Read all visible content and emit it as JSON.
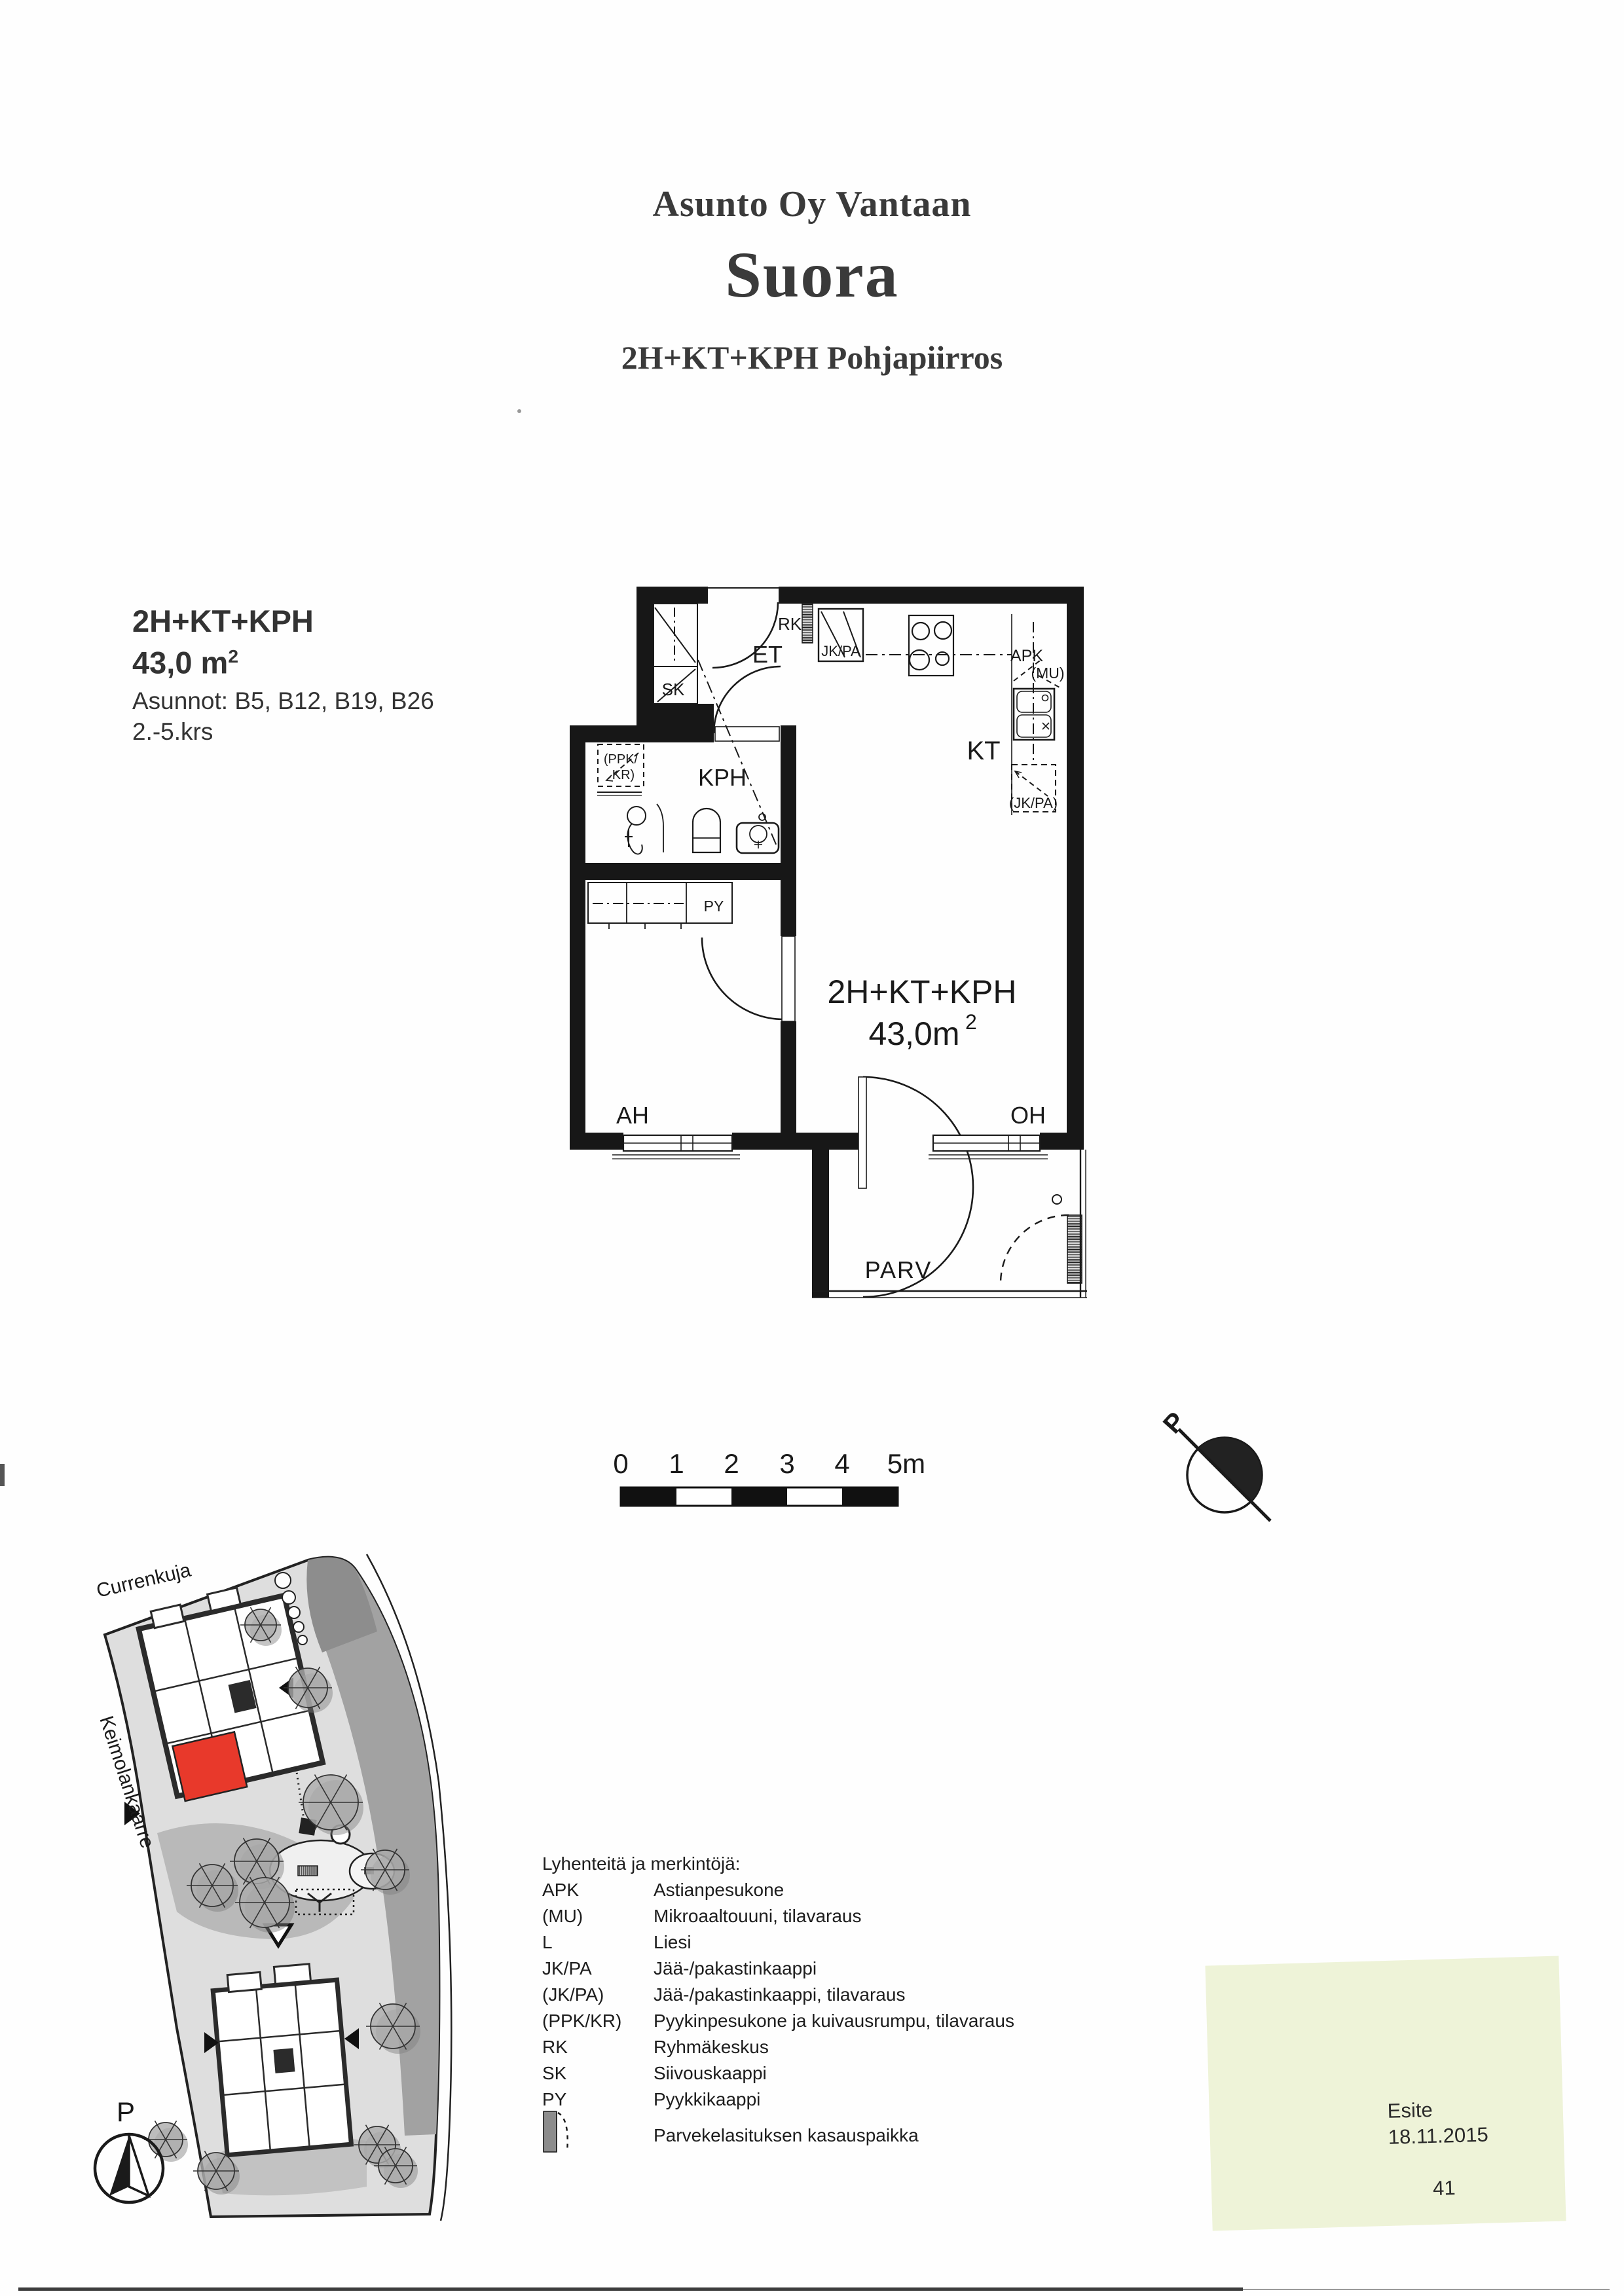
{
  "title": {
    "line1": "Asunto Oy Vantaan",
    "line2": "Suora",
    "line3": "2H+KT+KPH Pohjapiirros"
  },
  "unit_info": {
    "type": "2H+KT+KPH",
    "area": "43,0 m",
    "area_sup": "2",
    "apartments": "Asunnot: B5, B12, B19, B26",
    "floors": "2.-5.krs"
  },
  "floor_plan": {
    "labels": {
      "et": "ET",
      "sk": "SK",
      "rk": "RK",
      "jk_pa": "JK/PA",
      "kt": "KT",
      "apk": "APK",
      "mu": "(MU)",
      "jk_pa_reserve": "(JK/PA)",
      "kph": "KPH",
      "ppk_kr_line1": "(PPK/",
      "ppk_kr_line2": "KR)",
      "py": "PY",
      "ah": "AH",
      "oh": "OH",
      "parv": "PARV"
    },
    "area_label": {
      "line1": "2H+KT+KPH",
      "value": "43,0m",
      "sup": "2"
    }
  },
  "scale_bar": {
    "ticks": [
      "0",
      "1",
      "2",
      "3",
      "4",
      "5m"
    ]
  },
  "north_arrow": {
    "label": "P"
  },
  "site_plan": {
    "street_top": "Currenkuja",
    "street_left": "Keimolankaarre",
    "compass_label": "P"
  },
  "legend": {
    "title": "Lyhenteitä ja merkintöjä:",
    "rows": [
      {
        "abbr": "APK",
        "desc": "Astianpesukone"
      },
      {
        "abbr": "(MU)",
        "desc": "Mikroaaltouuni, tilavaraus"
      },
      {
        "abbr": "L",
        "desc": "Liesi"
      },
      {
        "abbr": "JK/PA",
        "desc": "Jää-/pakastinkaappi"
      },
      {
        "abbr": "(JK/PA)",
        "desc": "Jää-/pakastinkaappi, tilavaraus"
      },
      {
        "abbr": "(PPK/KR)",
        "desc": "Pyykinpesukone ja kuivausrumpu, tilavaraus"
      },
      {
        "abbr": "RK",
        "desc": "Ryhmäkeskus"
      },
      {
        "abbr": "SK",
        "desc": "Siivouskaappi"
      },
      {
        "abbr": "PY",
        "desc": "Pyykkikaappi"
      },
      {
        "abbr": "",
        "desc": "Parvekelasituksen kasauspaikka"
      }
    ]
  },
  "note": {
    "doc_type": "Esite",
    "date": "18.11.2015",
    "page_number": "41"
  },
  "colors": {
    "highlight_red": "#e8392b",
    "note_background": "#eef3d8",
    "ink": "#1a1a1a"
  }
}
